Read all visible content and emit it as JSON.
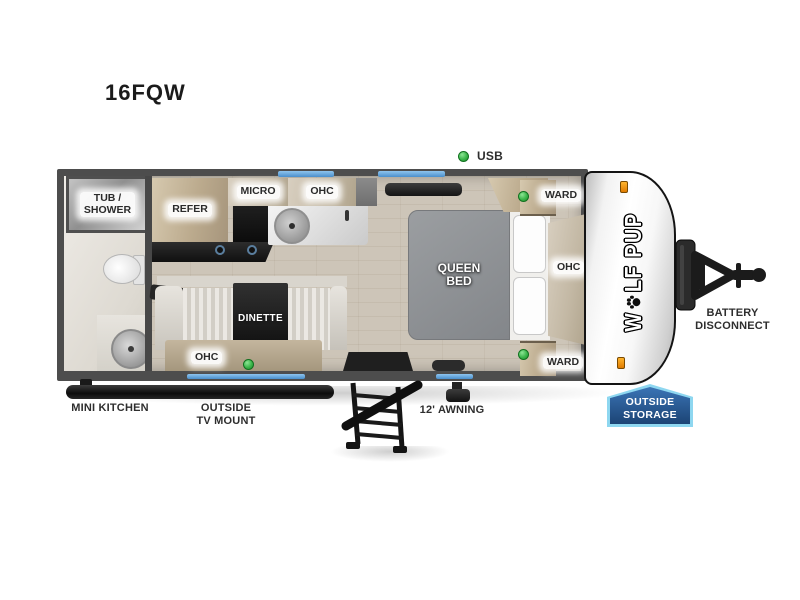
{
  "title": "16FQW",
  "plan": {
    "bathroom": {
      "tub_shower": "TUB /\nSHOWER"
    },
    "kitchen": {
      "refer": "REFER",
      "micro": "MICRO",
      "ohc": "OHC"
    },
    "dinette": {
      "table": "DINETTE",
      "ohc": "OHC"
    },
    "bedroom": {
      "bed": "QUEEN\nBED",
      "ward_top": "WARD",
      "ward_bottom": "WARD",
      "ohc": "OHC",
      "usb": "USB"
    }
  },
  "exterior": {
    "mini_kitchen": "MINI KITCHEN",
    "tv_mount": "OUTSIDE\nTV MOUNT",
    "awning": "12' AWNING",
    "battery": "BATTERY\nDISCONNECT",
    "storage": "OUTSIDE\nSTORAGE"
  },
  "brand": {
    "prefix": "W",
    "suffix": "LF PUP"
  },
  "colors": {
    "window_blue": "#5ba0d9",
    "indicator_green": "#3bb54a",
    "badge_fill": "#235a99",
    "badge_border": "#8ed7f0",
    "marker_orange": "#f59a23"
  },
  "icons": {
    "indicator": "green-dot",
    "logo_o": "paw-print"
  }
}
